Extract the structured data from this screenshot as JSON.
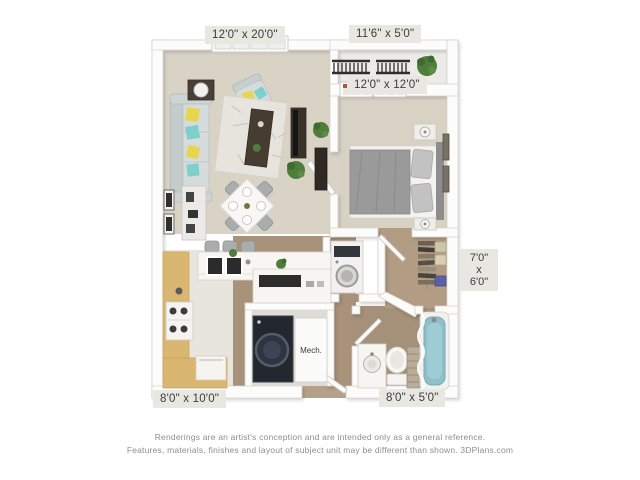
{
  "floor_plan": {
    "rooms": [
      {
        "name": "living-dining",
        "dimensions": "12'0\" x 20'0\""
      },
      {
        "name": "balcony",
        "dimensions": "11'6\" x 5'0\""
      },
      {
        "name": "bedroom",
        "dimensions": "12'0\" x 12'0\""
      },
      {
        "name": "walk-in-closet",
        "dimensions_lines": [
          "7'0\"",
          "x",
          "6'0\""
        ]
      },
      {
        "name": "kitchen",
        "dimensions": "8'0\" x 10'0\""
      },
      {
        "name": "bathroom",
        "dimensions": "8'0\" x 5'0\""
      }
    ],
    "mech_closet_label": "Mech.",
    "palette": {
      "wall": "#fcfcfb",
      "carpet_floor": "#d9d3c6",
      "wood_floor": "#a8927a",
      "kitchen_floor": "#e8e5df",
      "counter_wood": "#d9b671",
      "tub_teal": "#8fc0ca",
      "plant_green": "#4f7d3c",
      "sofa_gray": "#d6dcdc",
      "pillow_yellow": "#e8d44d",
      "pillow_teal": "#7fd0ca",
      "label_bg": "#e9e7e2",
      "label_text": "#3c3c3c",
      "footer_text": "#8e8e8e"
    }
  },
  "footer": {
    "line1": "Renderings are an artist's conception and are intended only as a general reference.",
    "line2": "Features, materials, finishes and layout of subject unit may be different than shown. 3DPlans.com"
  }
}
